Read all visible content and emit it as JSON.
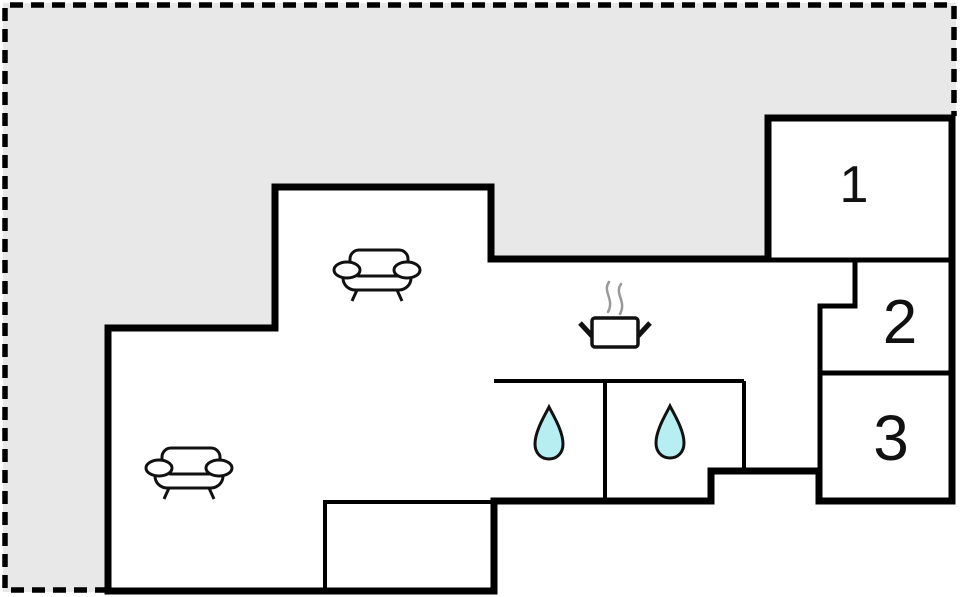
{
  "plan": {
    "type": "floor-plan",
    "colors": {
      "background": "#ffffff",
      "outdoor_area": "#e8e8e8",
      "walls": "#000000",
      "water_drop": "#b6eef2",
      "steam": "#999999"
    },
    "rooms": [
      {
        "label": "1"
      },
      {
        "label": "2"
      },
      {
        "label": "3"
      }
    ],
    "icons": [
      "sofa-icon",
      "sofa-icon",
      "cooking-pot-icon",
      "water-drop-icon",
      "water-drop-icon"
    ]
  }
}
